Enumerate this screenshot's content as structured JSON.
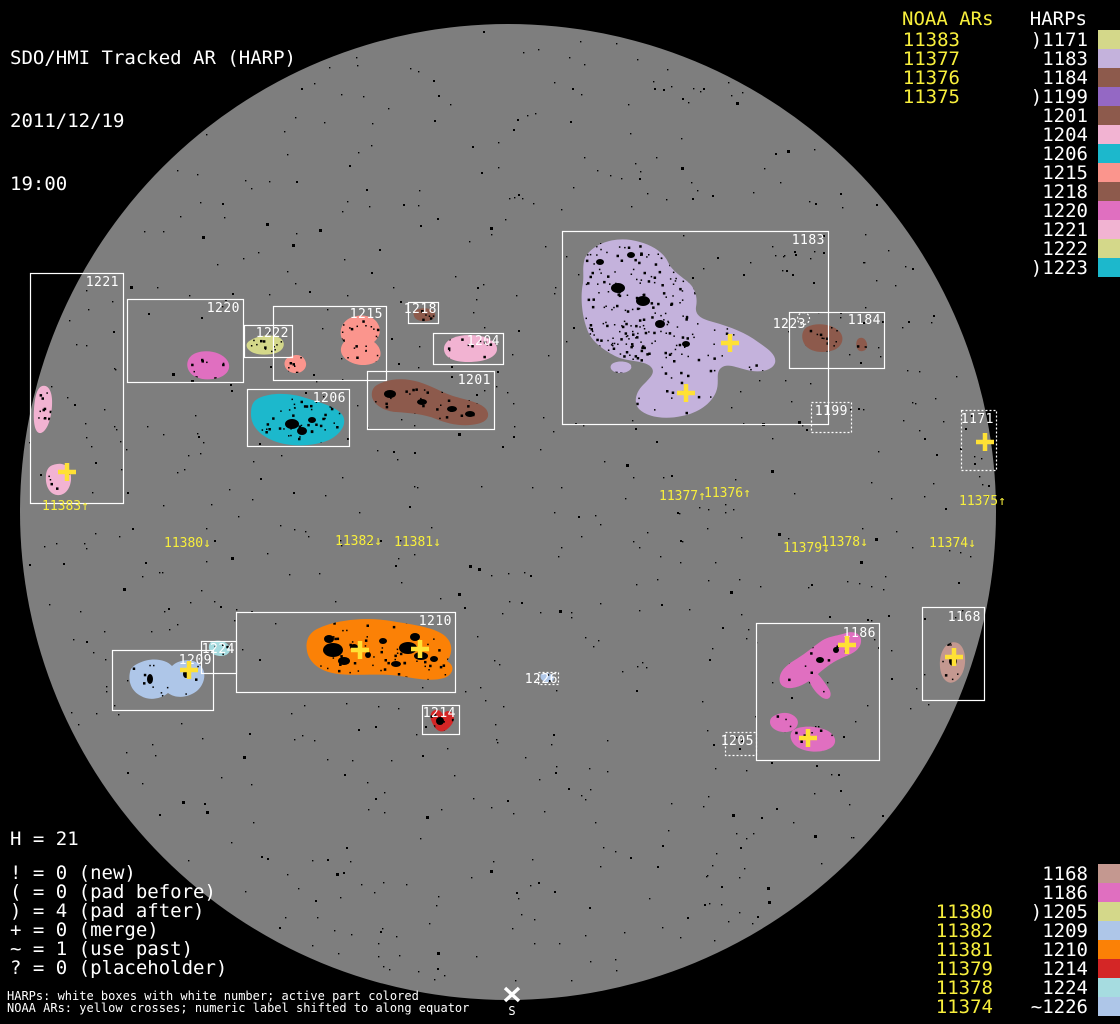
{
  "header": {
    "title": "SDO/HMI Tracked AR (HARP)",
    "date": "2011/12/19",
    "time": "19:00"
  },
  "colors": {
    "background": "#000000",
    "disk": "#7e7e7e",
    "box_stroke": "#ffffff",
    "label_white": "#ffffff",
    "noaa_yellow": "#f8ef3c",
    "cross_yellow": "#ffe135"
  },
  "panel_top_right": {
    "noaa_header": "NOAA ARs",
    "harps_header": "HARPs",
    "noaa_items": [
      "11383",
      "11377",
      "11376",
      "11375"
    ],
    "harp_items": [
      {
        "prefix": ")",
        "id": "1171",
        "color": "#d4d88a"
      },
      {
        "prefix": "",
        "id": "1183",
        "color": "#c4b2dc"
      },
      {
        "prefix": "",
        "id": "1184",
        "color": "#8d5a4c"
      },
      {
        "prefix": ")",
        "id": "1199",
        "color": "#9468c4"
      },
      {
        "prefix": "",
        "id": "1201",
        "color": "#8d5a4c"
      },
      {
        "prefix": "",
        "id": "1204",
        "color": "#f2b3d2"
      },
      {
        "prefix": "",
        "id": "1206",
        "color": "#1cb8cc"
      },
      {
        "prefix": "",
        "id": "1215",
        "color": "#fb958d"
      },
      {
        "prefix": "",
        "id": "1218",
        "color": "#8d5a4c"
      },
      {
        "prefix": "",
        "id": "1220",
        "color": "#e06fc0"
      },
      {
        "prefix": "",
        "id": "1221",
        "color": "#f2b3d2"
      },
      {
        "prefix": "",
        "id": "1222",
        "color": "#d4d88a"
      },
      {
        "prefix": ")",
        "id": "1223",
        "color": "#1cb8cc"
      }
    ]
  },
  "panel_bottom_right": {
    "rows": [
      {
        "noaa": "",
        "prefix": "",
        "id": "1168",
        "color": "#c49890"
      },
      {
        "noaa": "",
        "prefix": "",
        "id": "1186",
        "color": "#e06fc0"
      },
      {
        "noaa": "11380",
        "prefix": ")",
        "id": "1205",
        "color": "#d4d88a"
      },
      {
        "noaa": "11382",
        "prefix": "",
        "id": "1209",
        "color": "#aec6e8"
      },
      {
        "noaa": "11381",
        "prefix": "",
        "id": "1210",
        "color": "#fb8106"
      },
      {
        "noaa": "11379",
        "prefix": "",
        "id": "1214",
        "color": "#d42626"
      },
      {
        "noaa": "11378",
        "prefix": "",
        "id": "1224",
        "color": "#a6dce0"
      },
      {
        "noaa": "11374",
        "prefix": "~",
        "id": "1226",
        "color": "#aec6e8"
      }
    ]
  },
  "stats": {
    "h_line": "H = 21",
    "counters": [
      {
        "symbol": "!",
        "value": "0",
        "meaning": "new"
      },
      {
        "symbol": "(",
        "value": "0",
        "meaning": "pad before"
      },
      {
        "symbol": ")",
        "value": "4",
        "meaning": "pad after"
      },
      {
        "symbol": "+",
        "value": "0",
        "meaning": "merge"
      },
      {
        "symbol": "~",
        "value": "1",
        "meaning": "use past"
      },
      {
        "symbol": "?",
        "value": "0",
        "meaning": "placeholder"
      }
    ]
  },
  "footer": {
    "line1": "HARPs: white boxes with white number; active part colored",
    "line2": "NOAA ARs: yellow crosses; numeric label shifted to along equator"
  },
  "south_marker": {
    "label": "S"
  },
  "disk": {
    "harp_boxes": [
      {
        "id": "1221",
        "x": 30,
        "y": 273,
        "w": 93,
        "h": 230,
        "dotted": false,
        "label_x": 119,
        "label_y": 286
      },
      {
        "id": "1220",
        "x": 127,
        "y": 299,
        "w": 116,
        "h": 83,
        "dotted": false,
        "label_x": 240,
        "label_y": 312
      },
      {
        "id": "1222",
        "x": 244,
        "y": 325,
        "w": 48,
        "h": 32,
        "dotted": false,
        "label_x": 289,
        "label_y": 337
      },
      {
        "id": "1215",
        "x": 273,
        "y": 306,
        "w": 113,
        "h": 74,
        "dotted": false,
        "label_x": 383,
        "label_y": 318
      },
      {
        "id": "1218",
        "x": 408,
        "y": 302,
        "w": 30,
        "h": 21,
        "dotted": false,
        "label_x": 437,
        "label_y": 313
      },
      {
        "id": "1204",
        "x": 433,
        "y": 333,
        "w": 70,
        "h": 31,
        "dotted": false,
        "label_x": 500,
        "label_y": 345
      },
      {
        "id": "1206",
        "x": 247,
        "y": 389,
        "w": 102,
        "h": 57,
        "dotted": false,
        "label_x": 346,
        "label_y": 402
      },
      {
        "id": "1201",
        "x": 367,
        "y": 371,
        "w": 127,
        "h": 58,
        "dotted": false,
        "label_x": 491,
        "label_y": 384
      },
      {
        "id": "1183",
        "x": 562,
        "y": 231,
        "w": 266,
        "h": 193,
        "dotted": false,
        "label_x": 825,
        "label_y": 244
      },
      {
        "id": "1184",
        "x": 789,
        "y": 312,
        "w": 95,
        "h": 56,
        "dotted": false,
        "label_x": 881,
        "label_y": 324
      },
      {
        "id": "1223",
        "x": 797,
        "y": 312,
        "w": 12,
        "h": 12,
        "dotted": true,
        "label_x": 806,
        "label_y": 328
      },
      {
        "id": "1199",
        "x": 811,
        "y": 402,
        "w": 40,
        "h": 30,
        "dotted": true,
        "label_x": 848,
        "label_y": 415
      },
      {
        "id": "1171",
        "x": 961,
        "y": 410,
        "w": 35,
        "h": 60,
        "dotted": true,
        "label_x": 994,
        "label_y": 423
      },
      {
        "id": "1210",
        "x": 236,
        "y": 612,
        "w": 219,
        "h": 80,
        "dotted": false,
        "label_x": 452,
        "label_y": 625
      },
      {
        "id": "1209",
        "x": 112,
        "y": 650,
        "w": 101,
        "h": 60,
        "dotted": false,
        "label_x": 212,
        "label_y": 664
      },
      {
        "id": "1224",
        "x": 201,
        "y": 641,
        "w": 35,
        "h": 32,
        "dotted": false,
        "label_x": 235,
        "label_y": 653
      },
      {
        "id": "1214",
        "x": 422,
        "y": 705,
        "w": 37,
        "h": 29,
        "dotted": false,
        "label_x": 456,
        "label_y": 717
      },
      {
        "id": "1226",
        "x": 538,
        "y": 672,
        "w": 20,
        "h": 12,
        "dotted": true,
        "label_x": 558,
        "label_y": 683
      },
      {
        "id": "1186",
        "x": 756,
        "y": 623,
        "w": 123,
        "h": 137,
        "dotted": false,
        "label_x": 876,
        "label_y": 637
      },
      {
        "id": "1205",
        "x": 725,
        "y": 732,
        "w": 31,
        "h": 23,
        "dotted": true,
        "label_x": 754,
        "label_y": 745
      },
      {
        "id": "1168",
        "x": 922,
        "y": 607,
        "w": 62,
        "h": 93,
        "dotted": false,
        "label_x": 981,
        "label_y": 621
      }
    ],
    "noaa_crosses": [
      {
        "x": 67,
        "y": 472
      },
      {
        "x": 686,
        "y": 393
      },
      {
        "x": 730,
        "y": 343
      },
      {
        "x": 985,
        "y": 442
      },
      {
        "x": 189,
        "y": 670
      },
      {
        "x": 360,
        "y": 650
      },
      {
        "x": 420,
        "y": 649
      },
      {
        "x": 954,
        "y": 657
      },
      {
        "x": 847,
        "y": 645
      },
      {
        "x": 808,
        "y": 738
      }
    ],
    "equator_labels": [
      {
        "text": "11383",
        "arrow": "↑",
        "x": 42,
        "y": 510
      },
      {
        "text": "11380",
        "arrow": "↓",
        "x": 164,
        "y": 547
      },
      {
        "text": "11382",
        "arrow": "↓",
        "x": 335,
        "y": 545
      },
      {
        "text": "11381",
        "arrow": "↓",
        "x": 394,
        "y": 546
      },
      {
        "text": "11377",
        "arrow": "↑",
        "x": 659,
        "y": 500
      },
      {
        "text": "11376",
        "arrow": "↑",
        "x": 704,
        "y": 497
      },
      {
        "text": "11379",
        "arrow": "↓",
        "x": 783,
        "y": 552
      },
      {
        "text": "11378",
        "arrow": "↓",
        "x": 821,
        "y": 546
      },
      {
        "text": "11375",
        "arrow": "↑",
        "x": 959,
        "y": 505
      },
      {
        "text": "11374",
        "arrow": "↓",
        "x": 929,
        "y": 547
      }
    ]
  }
}
